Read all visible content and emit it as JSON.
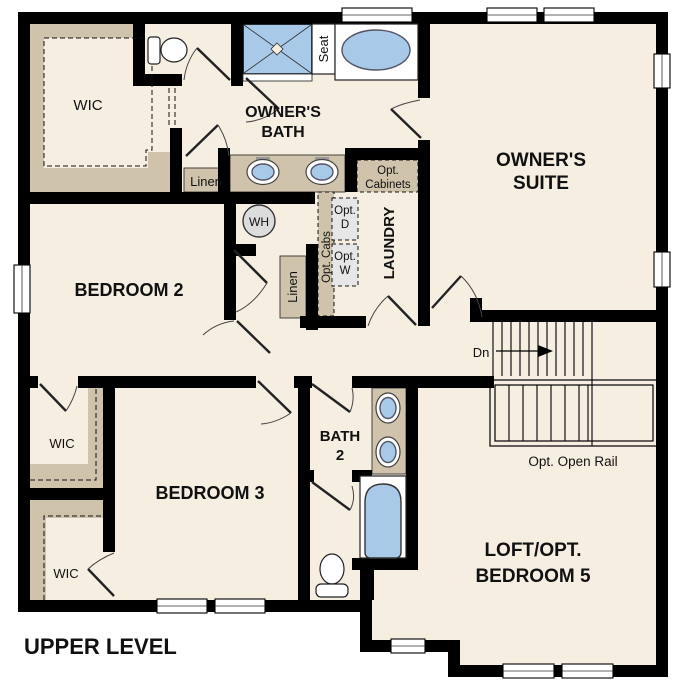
{
  "title": "UPPER LEVEL",
  "colors": {
    "floor": "#f6eee1",
    "wall": "#000000",
    "shelf_tan": "#d0c3ab",
    "fixture_blue": "#a9c9e8",
    "appliance_gray": "#e6e6e6",
    "wh_gray": "#dcdcdc",
    "text": "#111111"
  },
  "rooms": {
    "owners_suite_1": "OWNER'S",
    "owners_suite_2": "SUITE",
    "owners_bath_1": "OWNER'S",
    "owners_bath_2": "BATH",
    "bedroom2": "BEDROOM 2",
    "bedroom3": "BEDROOM 3",
    "bath2_1": "BATH",
    "bath2_2": "2",
    "loft_1": "LOFT/OPT.",
    "loft_2": "BEDROOM 5",
    "laundry": "LAUNDRY",
    "wic_top": "WIC",
    "wic_mid": "WIC",
    "wic_bot": "WIC",
    "linen_1": "Linen",
    "linen_2": "Linen"
  },
  "callouts": {
    "seat": "Seat",
    "wh": "WH",
    "dn": "Dn",
    "opt_cabinets_1": "Opt.",
    "opt_cabinets_2": "Cabinets",
    "opt_cabs": "Opt. Cabs",
    "opt_d_1": "Opt.",
    "opt_d_2": "D",
    "opt_w_1": "Opt.",
    "opt_w_2": "W",
    "opt_open_rail": "Opt. Open Rail"
  }
}
